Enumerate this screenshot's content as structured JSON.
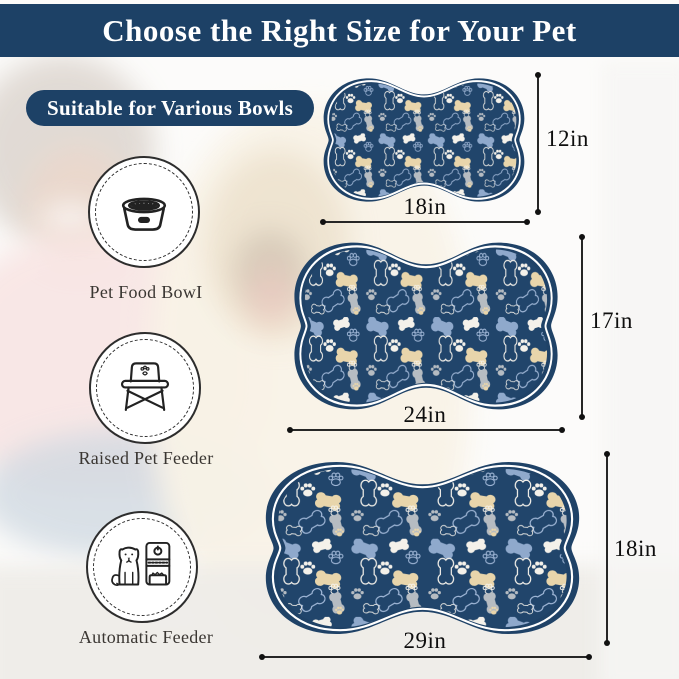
{
  "header": {
    "title": "Choose the Right Size for Your Pet"
  },
  "badge": {
    "label": "Suitable for Various Bowls"
  },
  "bowl_types": [
    {
      "label": "Pet Food BowI",
      "icon": "pet-food-bowl-icon"
    },
    {
      "label": "Raised Pet Feeder",
      "icon": "raised-pet-feeder-icon"
    },
    {
      "label": "Automatic Feeder",
      "icon": "automatic-feeder-icon"
    }
  ],
  "mats": [
    {
      "size": "small",
      "width_in": 18,
      "height_in": 12,
      "width_label": "18in",
      "height_label": "12in"
    },
    {
      "size": "medium",
      "width_in": 24,
      "height_in": 17,
      "width_label": "24in",
      "height_label": "17in"
    },
    {
      "size": "large",
      "width_in": 29,
      "height_in": 18,
      "width_label": "29in",
      "height_label": "18in"
    }
  ],
  "colors": {
    "navy": "#1d4166",
    "mat_navy": "#21456b",
    "bone_light_blue": "#8fa9cc",
    "bone_beige": "#e8d5ab",
    "bone_grey": "#b6bcc2",
    "bone_white": "#f4f1ea",
    "outline_blue": "#9fb6d6"
  }
}
